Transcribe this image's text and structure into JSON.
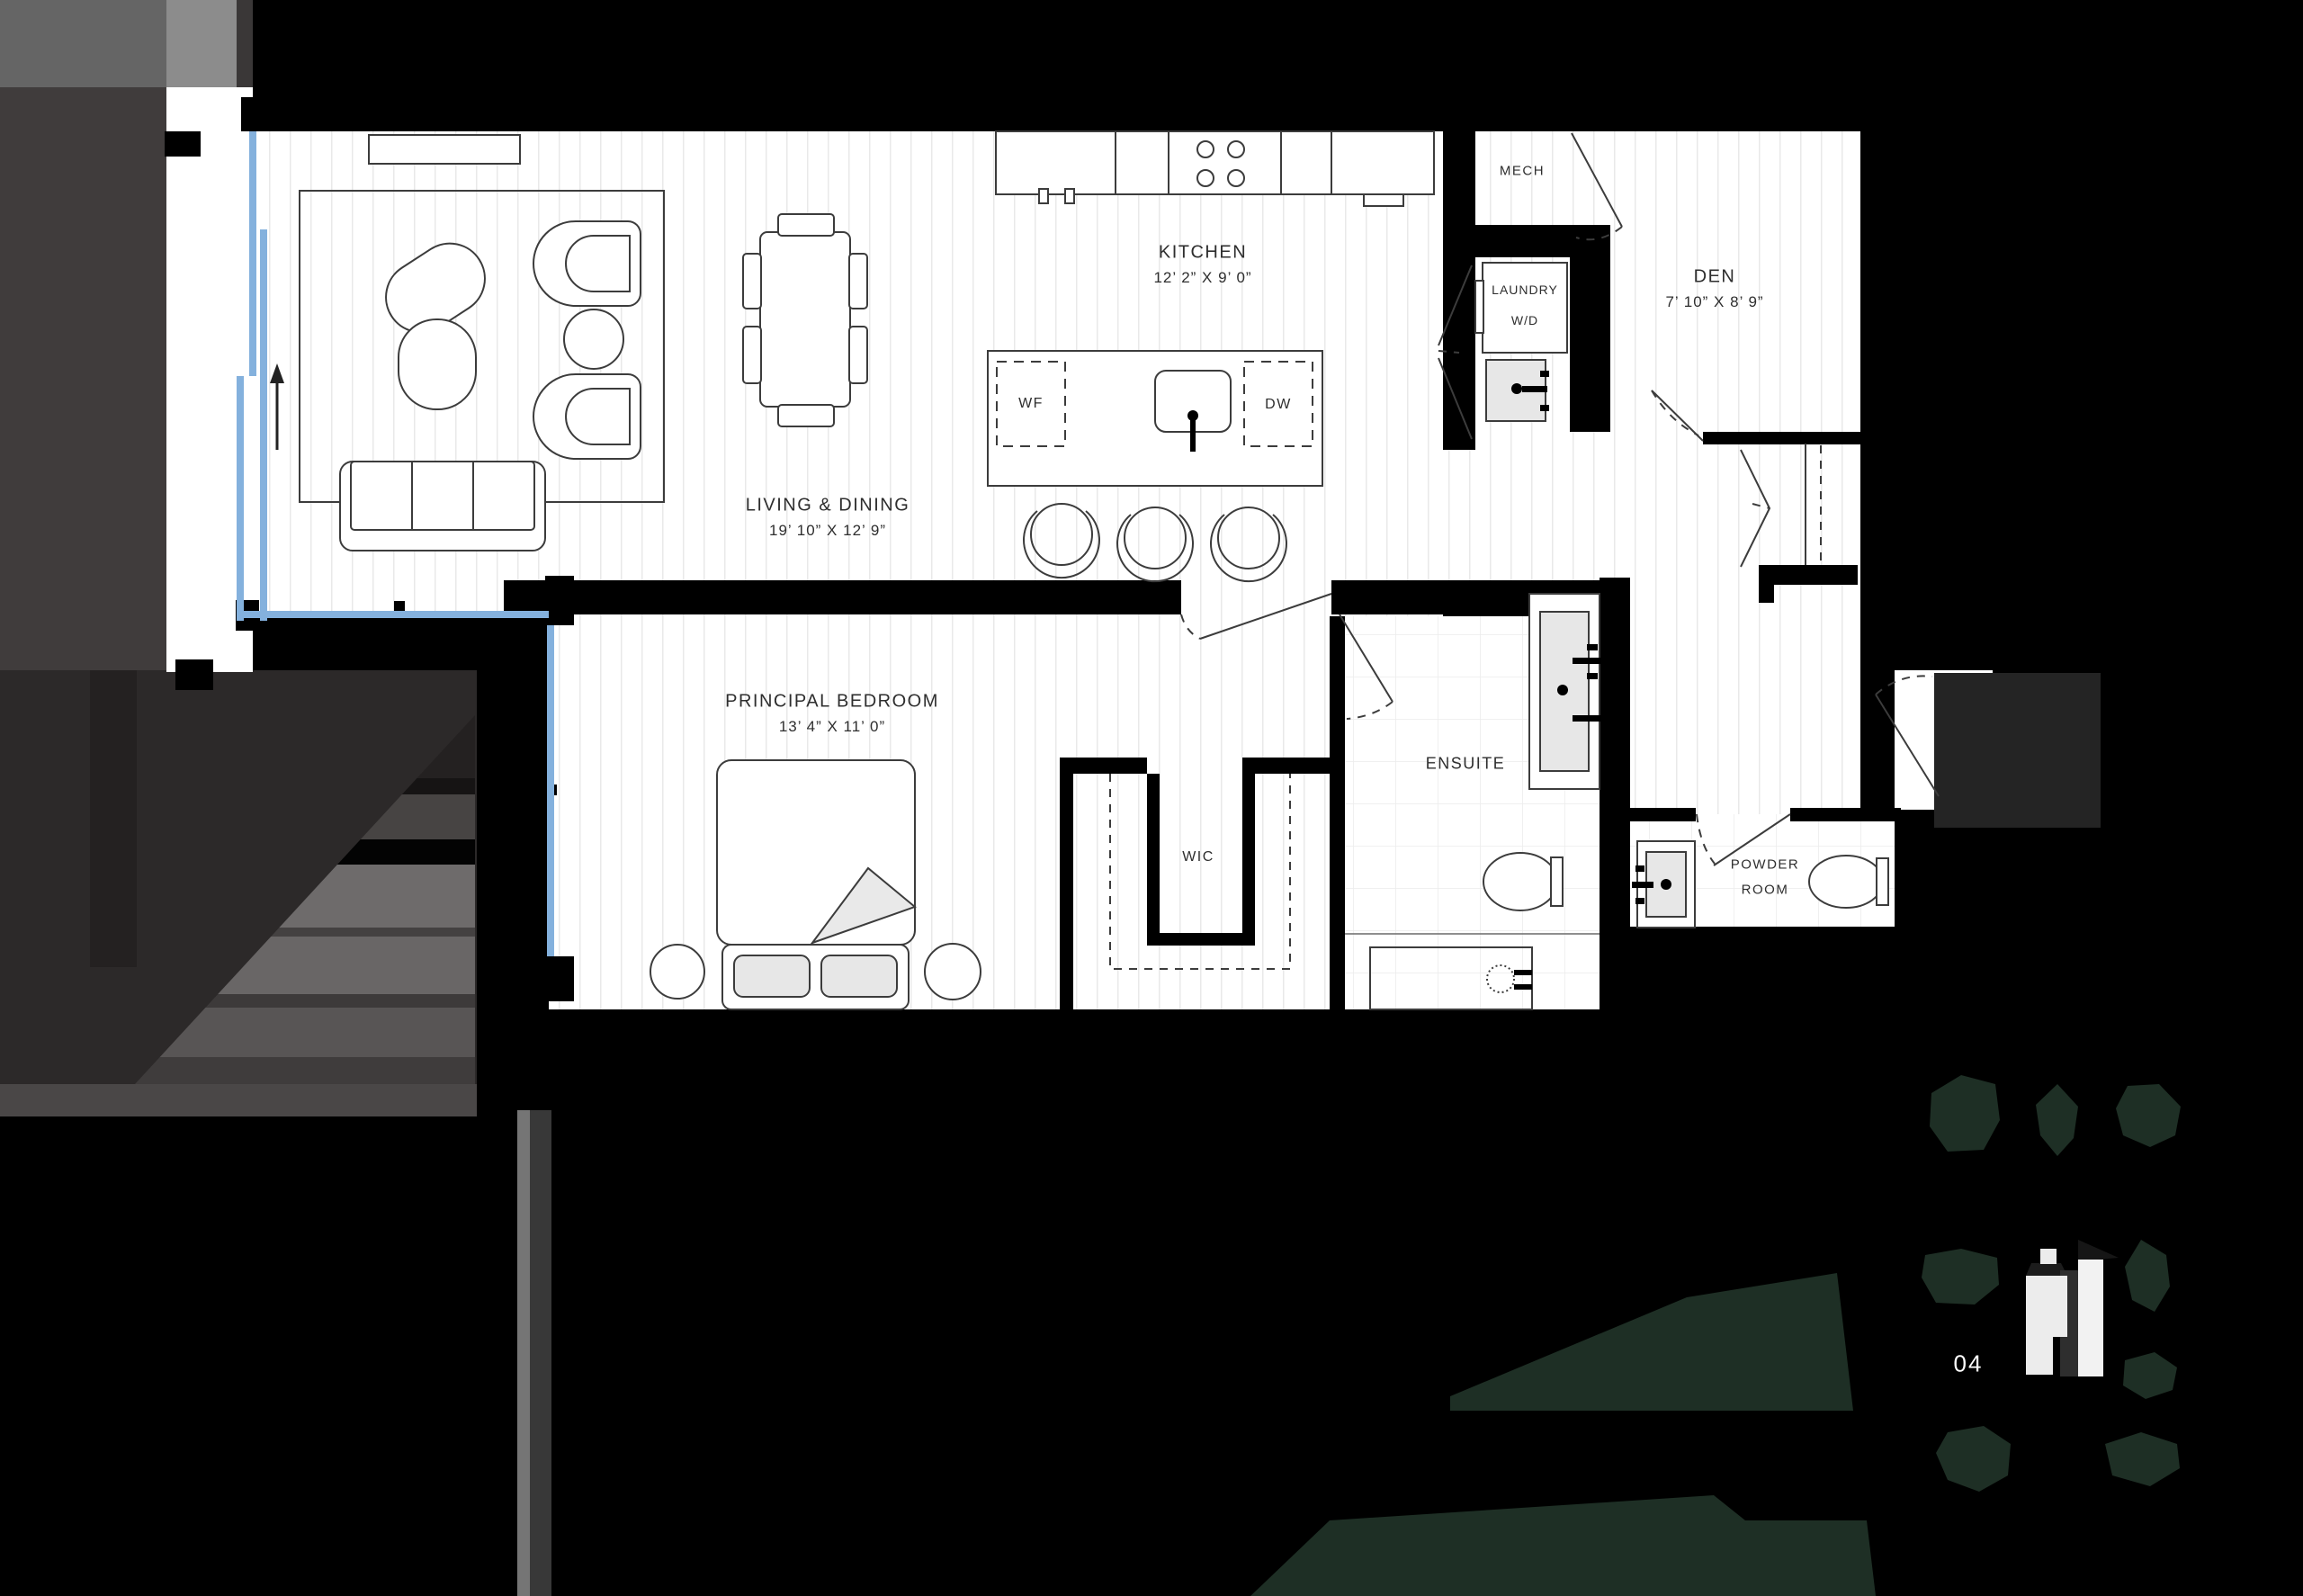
{
  "plan": {
    "rooms": {
      "kitchen": {
        "label": "KITCHEN",
        "dims": "12’ 2”  X 9’ 0”"
      },
      "living_dining": {
        "label": "LIVING & DINING",
        "dims": "19’ 10” X 12’ 9”"
      },
      "principal_bedroom": {
        "label": "PRINCIPAL BEDROOM",
        "dims": "13’ 4” X 11’ 0”"
      },
      "den": {
        "label": "DEN",
        "dims": "7’ 10”  X 8’ 9”"
      },
      "mech": {
        "label": "MECH"
      },
      "laundry": {
        "label_line1": "LAUNDRY",
        "label_line2": "W/D"
      },
      "wic": {
        "label": "WIC"
      },
      "ensuite": {
        "label": "ENSUITE"
      },
      "powder_room": {
        "label_line1": "POWDER",
        "label_line2": "ROOM"
      }
    },
    "fixtures": {
      "wine_fridge": "WF",
      "dishwasher": "DW"
    }
  },
  "site_plan": {
    "unit_number": "04"
  },
  "colors": {
    "background": "#000000",
    "wall": "#000000",
    "floor": "#ffffff",
    "plank_line": "#e9e9e9",
    "tile_line": "#ececec",
    "glazing_blue": "#84b1dd",
    "tree_green": "#1e2f25",
    "context_gray_light": "#8c8c8c",
    "context_gray_mid": "#656565",
    "context_gray_dark": "#403c3c",
    "building_footprint": "#ececec"
  }
}
